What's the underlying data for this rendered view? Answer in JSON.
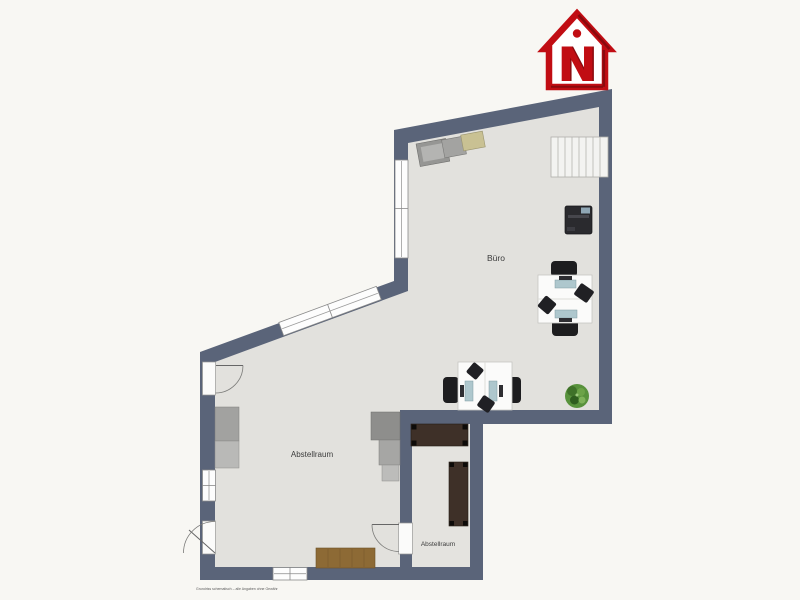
{
  "page": {
    "background_color": "#f8f7f3"
  },
  "floor_plan": {
    "wall_color": "#5a6479",
    "floor_color": "#e2e1dd",
    "rooms": [
      {
        "label": "Büro"
      },
      {
        "label": "Abstellraum"
      },
      {
        "label": "Abstellraum"
      }
    ],
    "furniture_icons": [
      "staircase",
      "printer",
      "meeting-workstation-vertical",
      "meeting-workstation-horizontal",
      "potted-plant",
      "wardrobe-cabinets",
      "storage-shelves-stepped",
      "wall-cabinet",
      "wood-sideboard",
      "dark-storage-table-horizontal",
      "dark-storage-table-vertical"
    ],
    "disclaimer": "Grundriss schematisch – alle Angaben ohne Gewähr"
  },
  "logo": {
    "letter": "N",
    "color": "#c10d13"
  }
}
